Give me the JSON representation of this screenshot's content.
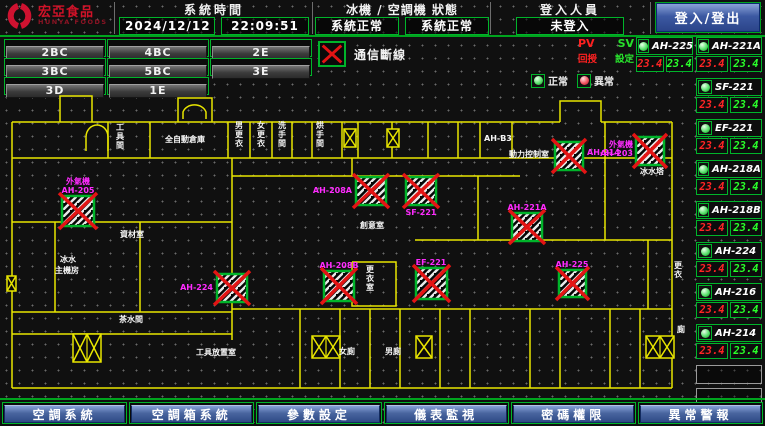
{
  "header": {
    "brand": "宏亞食品",
    "brand_sub": "HUNYA FOODS",
    "time_label": "系統時間",
    "date": "2024/12/12",
    "time": "22:09:51",
    "status_label": "冰機 / 空調機 狀態",
    "chiller_status": "系統正常",
    "ahu_status": "系統正常",
    "login_label": "登入人員",
    "login_value": "未登入",
    "login_button": "登入/登出"
  },
  "floor_buttons": [
    "2BC",
    "4BC",
    "2E",
    "3BC",
    "5BC",
    "3E",
    "3D",
    "1E"
  ],
  "legend": {
    "comm_loss": "通信斷線",
    "normal": "正常",
    "abnormal": "異常"
  },
  "ahu_panel": {
    "pv_label": "PV",
    "sv_label": "SV",
    "pv_sub_label": "回授",
    "sv_sub_label": "設定",
    "featured_unit": {
      "name": "AH-225",
      "pv": "23.4",
      "sv": "23.4"
    },
    "units": [
      {
        "name": "AH-221A",
        "pv": "23.4",
        "sv": "23.4"
      },
      {
        "name": "SF-221",
        "pv": "23.4",
        "sv": "23.4"
      },
      {
        "name": "EF-221",
        "pv": "23.4",
        "sv": "23.4"
      },
      {
        "name": "AH-218A",
        "pv": "23.4",
        "sv": "23.4"
      },
      {
        "name": "AH-218B",
        "pv": "23.4",
        "sv": "23.4"
      },
      {
        "name": "AH-224",
        "pv": "23.4",
        "sv": "23.4"
      },
      {
        "name": "AH-216",
        "pv": "23.4",
        "sv": "23.4"
      },
      {
        "name": "AH-214",
        "pv": "23.4",
        "sv": "23.4"
      }
    ],
    "empty_slots": 2
  },
  "nav_buttons": [
    "空調系統",
    "空調箱系統",
    "參數設定",
    "儀表監視",
    "密碼權限",
    "異常警報"
  ],
  "floor_plan": {
    "walls": [
      "60,122 60,96 92,96 92,122",
      "178,122 178,98 212,98 212,122",
      "560,122 560,101 601,101 601,122",
      "12,122 560,122",
      "601,122 672,122",
      "12,158 672,158",
      "12,122 12,388",
      "672,122 672,388",
      "12,388 672,388",
      "108,122 108,158",
      "150,122 150,158",
      "228,122 228,158",
      "250,122 250,158",
      "272,122 272,158",
      "292,122 292,158",
      "312,122 312,158",
      "342,122 342,158",
      "358,122 358,158",
      "392,122 392,158",
      "428,122 428,158",
      "458,122 458,158",
      "480,122 480,158",
      "512,122 512,158",
      "605,122 605,158",
      "232,176 520,176",
      "232,158 232,340",
      "12,222 232,222",
      "55,222 55,312",
      "140,222 140,312",
      "12,312 232,312",
      "352,158 352,176",
      "478,176 478,240",
      "415,240 672,240",
      "605,158 605,240",
      "648,240 648,309",
      "232,309 672,309",
      "300,309 300,388",
      "340,309 340,388",
      "370,309 370,388",
      "400,309 400,388",
      "440,309 440,388",
      "470,309 470,388",
      "530,309 530,388",
      "560,309 560,388",
      "610,309 610,388",
      "640,309 640,388",
      "12,334 232,334",
      "352,262 396,262 396,306 352,306 352,262"
    ],
    "arcs": [
      "M86,151 V137 a11,12 0 0 1 22,0 V151",
      "M183,119 V112 a12,10 0 0 1 23,0 V119"
    ],
    "stairs": [
      {
        "x": 73,
        "y": 334,
        "w": 28,
        "h": 28,
        "cells": 2
      },
      {
        "x": 312,
        "y": 336,
        "w": 28,
        "h": 22,
        "cells": 2
      },
      {
        "x": 416,
        "y": 336,
        "w": 16,
        "h": 22,
        "cells": 1
      },
      {
        "x": 646,
        "y": 336,
        "w": 28,
        "h": 22,
        "cells": 2
      },
      {
        "x": 344,
        "y": 129,
        "w": 12,
        "h": 18,
        "cells": 1
      },
      {
        "x": 387,
        "y": 129,
        "w": 12,
        "h": 18,
        "cells": 1
      },
      {
        "x": 7,
        "y": 276,
        "w": 9,
        "h": 15,
        "cells": 1
      }
    ],
    "devices": [
      {
        "x": 62,
        "y": 196,
        "w": 32,
        "h": 30,
        "labels": [
          {
            "t": "外氣機",
            "x": 78,
            "y": 184,
            "a": "middle"
          },
          {
            "t": "AH-205",
            "x": 78,
            "y": 193,
            "a": "middle"
          }
        ]
      },
      {
        "x": 356,
        "y": 177,
        "w": 30,
        "h": 28,
        "labels": [
          {
            "t": "AH-208A",
            "x": 352,
            "y": 193,
            "a": "end"
          }
        ]
      },
      {
        "x": 406,
        "y": 177,
        "w": 30,
        "h": 28,
        "labels": [
          {
            "t": "SF-221",
            "x": 421,
            "y": 215,
            "a": "middle"
          }
        ]
      },
      {
        "x": 555,
        "y": 142,
        "w": 28,
        "h": 28,
        "labels": [
          {
            "t": "AH-214",
            "x": 587,
            "y": 155,
            "a": "start"
          }
        ]
      },
      {
        "x": 636,
        "y": 137,
        "w": 28,
        "h": 28,
        "labels": [
          {
            "t": "外氣機",
            "x": 633,
            "y": 147,
            "a": "end"
          },
          {
            "t": "AH-203",
            "x": 633,
            "y": 156,
            "a": "end"
          }
        ]
      },
      {
        "x": 512,
        "y": 213,
        "w": 30,
        "h": 28,
        "labels": [
          {
            "t": "AH-221A",
            "x": 527,
            "y": 210,
            "a": "middle"
          }
        ]
      },
      {
        "x": 559,
        "y": 270,
        "w": 27,
        "h": 27,
        "labels": [
          {
            "t": "AH-225",
            "x": 572,
            "y": 267,
            "a": "middle"
          }
        ]
      },
      {
        "x": 416,
        "y": 268,
        "w": 31,
        "h": 31,
        "labels": [
          {
            "t": "EF-221",
            "x": 431,
            "y": 265,
            "a": "middle"
          }
        ]
      },
      {
        "x": 324,
        "y": 271,
        "w": 30,
        "h": 30,
        "labels": [
          {
            "t": "AH-208B",
            "x": 339,
            "y": 268,
            "a": "middle"
          }
        ]
      },
      {
        "x": 217,
        "y": 274,
        "w": 30,
        "h": 28,
        "labels": [
          {
            "t": "AH-224",
            "x": 213,
            "y": 290,
            "a": "end"
          }
        ]
      }
    ],
    "room_labels": [
      {
        "t": "工具間",
        "x": 116,
        "y": 130,
        "vert": true
      },
      {
        "t": "全自動倉庫",
        "x": 165,
        "y": 142
      },
      {
        "t": "男更衣",
        "x": 235,
        "y": 128,
        "vert": true
      },
      {
        "t": "女更衣",
        "x": 257,
        "y": 128,
        "vert": true
      },
      {
        "t": "洗手間",
        "x": 278,
        "y": 128,
        "vert": true
      },
      {
        "t": "烘手間",
        "x": 316,
        "y": 128,
        "vert": true
      },
      {
        "t": "AH-B3",
        "x": 484,
        "y": 141
      },
      {
        "t": "動力控制室",
        "x": 509,
        "y": 157
      },
      {
        "t": "冰水塔",
        "x": 640,
        "y": 174
      },
      {
        "t": "創意室",
        "x": 360,
        "y": 228
      },
      {
        "t": "資材室",
        "x": 120,
        "y": 237
      },
      {
        "t": "冰水",
        "x": 60,
        "y": 262
      },
      {
        "t": "主機房",
        "x": 55,
        "y": 273
      },
      {
        "t": "茶水間",
        "x": 119,
        "y": 322
      },
      {
        "t": "工具放置室",
        "x": 196,
        "y": 355
      },
      {
        "t": "更衣室",
        "x": 366,
        "y": 272,
        "vert": true
      },
      {
        "t": "女廁",
        "x": 339,
        "y": 354
      },
      {
        "t": "男廁",
        "x": 385,
        "y": 354
      },
      {
        "t": "更衣",
        "x": 674,
        "y": 268,
        "vert": true
      },
      {
        "t": "廁",
        "x": 677,
        "y": 332
      }
    ]
  },
  "colors": {
    "accent_green": "#00b42a",
    "wall_yellow": "#e8e500",
    "alarm_red": "#e31414",
    "label_magenta": "#ff2bff",
    "pv_red": "#ff2525",
    "sv_green": "#2aff2a",
    "nav_blue": "#3a5aa8"
  }
}
